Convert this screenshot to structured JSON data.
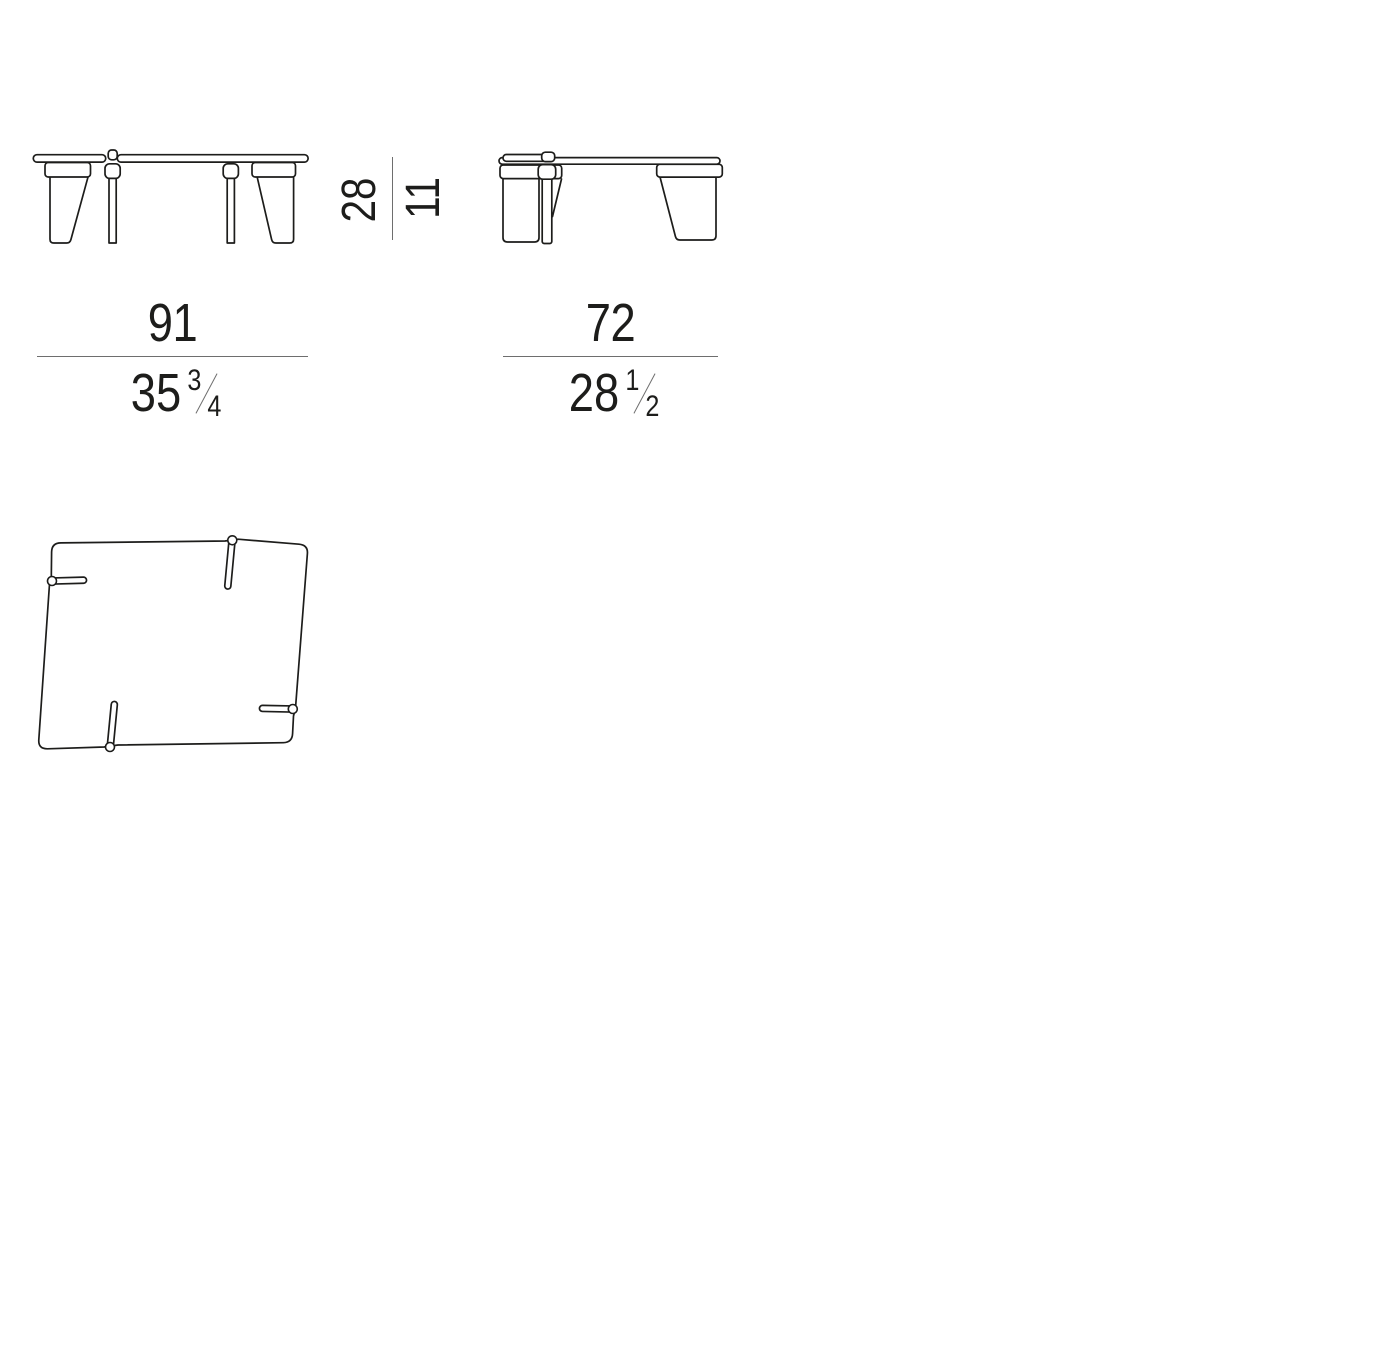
{
  "colors": {
    "line": "#1d1d1b",
    "dim": "#6e6e6e",
    "bg": "#ffffff"
  },
  "dimensions": {
    "height": {
      "cm": "28",
      "in": "11"
    },
    "width": {
      "cm": "91",
      "in_whole": "35",
      "in_numerator": "3",
      "in_denominator": "4"
    },
    "depth": {
      "cm": "72",
      "in_whole": "28",
      "in_numerator": "1",
      "in_denominator": "2"
    }
  }
}
